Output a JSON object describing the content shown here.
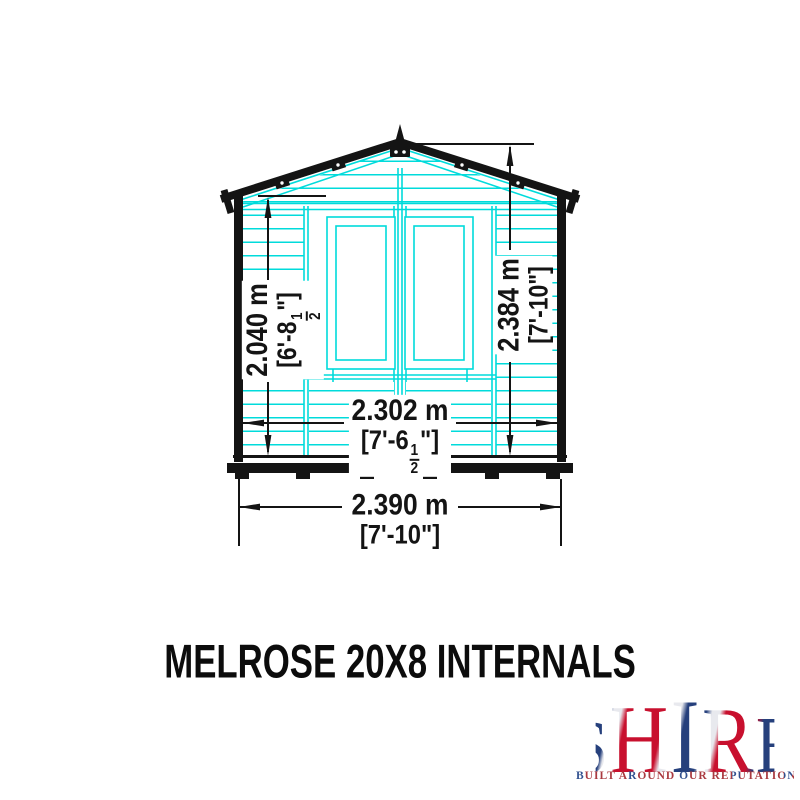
{
  "title": "MELROSE 20X8 INTERNALS",
  "diagram": {
    "type": "shed-front-elevation",
    "dimensions": {
      "height_left": {
        "metric": "2.040 m",
        "imperial_prefix": "[6'-8",
        "fraction_numerator": "1",
        "fraction_denominator": "2",
        "imperial_suffix": "\"]"
      },
      "height_right": {
        "metric": "2.384 m",
        "imperial": "[7'-10\"]"
      },
      "width_inner": {
        "metric": "2.302 m",
        "imperial_prefix": "[7'-6",
        "fraction_numerator": "1",
        "fraction_denominator": "2",
        "imperial_suffix": "\"]"
      },
      "width_outer": {
        "metric": "2.390 m",
        "imperial": "[7'-10\"]"
      }
    }
  },
  "logo": {
    "letters": [
      "S",
      "H",
      "I",
      "R",
      "E"
    ],
    "tagline": "BUILT AROUND OUR REPUTATION"
  },
  "colors": {
    "line_cyan": "#00dbdb",
    "line_black": "#141414",
    "background": "#ffffff",
    "logo_red": "#c8102e",
    "logo_blue": "#26407c"
  }
}
